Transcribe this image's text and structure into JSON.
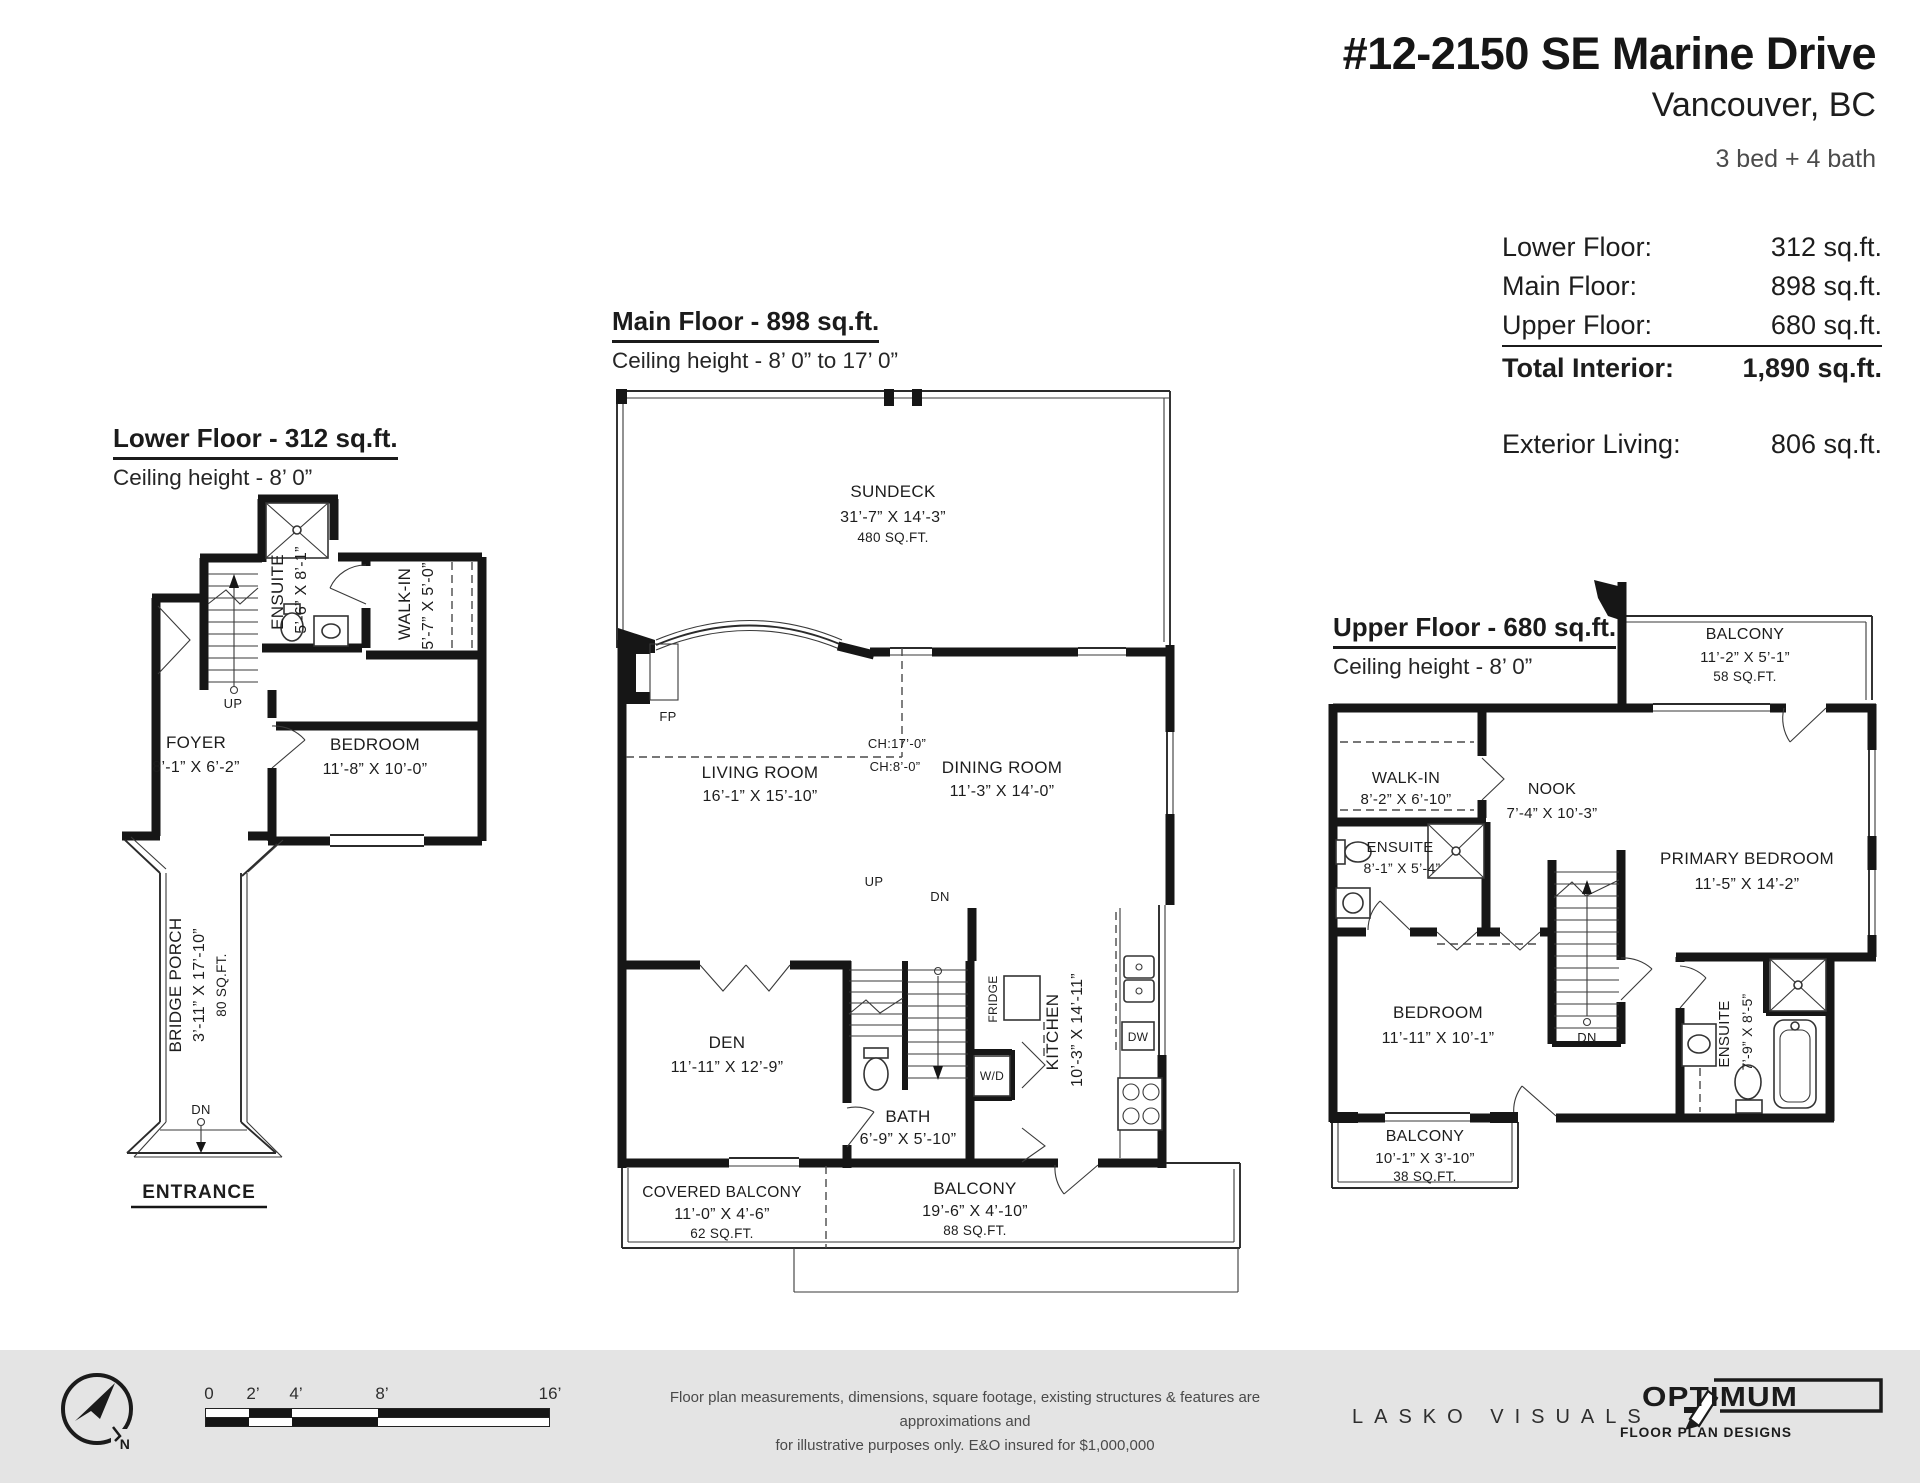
{
  "colors": {
    "ink": "#161616",
    "footer_bg": "#e4e4e4",
    "paper": "#ffffff"
  },
  "header": {
    "title": "#12-2150 SE Marine Drive",
    "subtitle": "Vancouver, BC",
    "beds_baths": "3 bed + 4 bath"
  },
  "stats": {
    "rows": [
      {
        "label": "Lower Floor:",
        "value": "312 sq.ft."
      },
      {
        "label": "Main Floor:",
        "value": "898 sq.ft."
      },
      {
        "label": "Upper Floor:",
        "value": "680 sq.ft."
      },
      {
        "label": "Total Interior:",
        "value": "1,890 sq.ft."
      }
    ],
    "exterior": {
      "label": "Exterior Living:",
      "value": "806 sq.ft."
    }
  },
  "floors": {
    "lower": {
      "title": "Lower Floor - 312 sq.ft.",
      "ceiling": "Ceiling height - 8’ 0”",
      "rooms": {
        "ensuite": {
          "name": "ENSUITE",
          "dims": "5’-6” X 8’-1”"
        },
        "walkin": {
          "name": "WALK-IN",
          "dims": "5’-7” X 5’-0”"
        },
        "bedroom": {
          "name": "BEDROOM",
          "dims": "11’-8” X 10’-0”"
        },
        "foyer": {
          "name": "FOYER",
          "dims": "8’-1” X 6’-2”"
        },
        "porch": {
          "name": "BRIDGE PORCH",
          "dims": "3’-11” X 17’-10”",
          "area": "80 SQ.FT."
        }
      },
      "labels": {
        "up": "UP",
        "dn": "DN",
        "entrance": "ENTRANCE"
      }
    },
    "main": {
      "title": "Main Floor - 898 sq.ft.",
      "ceiling": "Ceiling height - 8’ 0” to 17’ 0”",
      "rooms": {
        "sundeck": {
          "name": "SUNDECK",
          "dims": "31’-7” X 14’-3”",
          "area": "480 SQ.FT."
        },
        "living": {
          "name": "LIVING ROOM",
          "dims": "16’-1” X 15’-10”"
        },
        "dining": {
          "name": "DINING ROOM",
          "dims": "11’-3” X 14’-0”"
        },
        "den": {
          "name": "DEN",
          "dims": "11’-11” X 12’-9”"
        },
        "bath": {
          "name": "BATH",
          "dims": "6’-9” X 5’-10”"
        },
        "kitchen": {
          "name": "KITCHEN",
          "dims": "10’-3” X 14’-11”"
        },
        "covered_balcony": {
          "name": "COVERED BALCONY",
          "dims": "11’-0” X 4’-6”",
          "area": "62 SQ.FT."
        },
        "balcony": {
          "name": "BALCONY",
          "dims": "19’-6” X 4’-10”",
          "area": "88 SQ.FT."
        }
      },
      "labels": {
        "up": "UP",
        "dn": "DN",
        "fp": "FP",
        "fridge": "FRIDGE",
        "wd": "W/D",
        "dw": "DW",
        "ch17": "CH:17’-0”",
        "ch8": "CH:8’-0”"
      }
    },
    "upper": {
      "title": "Upper Floor - 680 sq.ft.",
      "ceiling": "Ceiling height - 8’ 0”",
      "rooms": {
        "balcony_top": {
          "name": "BALCONY",
          "dims": "11’-2” X 5’-1”",
          "area": "58 SQ.FT."
        },
        "walkin": {
          "name": "WALK-IN",
          "dims": "8’-2” X 6’-10”"
        },
        "nook": {
          "name": "NOOK",
          "dims": "7’-4” X 10’-3”"
        },
        "primary": {
          "name": "PRIMARY BEDROOM",
          "dims": "11’-5” X 14’-2”"
        },
        "ensuite_left": {
          "name": "ENSUITE",
          "dims": "8’-1” X 5’-4”"
        },
        "bedroom": {
          "name": "BEDROOM",
          "dims": "11’-11” X 10’-1”"
        },
        "ensuite_right": {
          "name": "ENSUITE",
          "dims": "7’-9” X 8’-5”"
        },
        "balcony_bottom": {
          "name": "BALCONY",
          "dims": "10’-1” X 3’-10”",
          "area": "38 SQ.FT."
        }
      },
      "labels": {
        "dn": "DN"
      }
    }
  },
  "footer": {
    "compass": {
      "letter": "N"
    },
    "scale": {
      "ticks": [
        "0",
        "2’",
        "4’",
        "8’",
        "16’"
      ]
    },
    "disclaimer_line1": "Floor plan measurements, dimensions, square footage, existing structures & features are approximations and",
    "disclaimer_line2": "for illustrative purposes only.  E&O insured for $1,000,000",
    "lasko": "LASKO VISUALS",
    "optimum": {
      "name": "OPTIMUM",
      "tagline": "FLOOR PLAN DESIGNS"
    }
  }
}
